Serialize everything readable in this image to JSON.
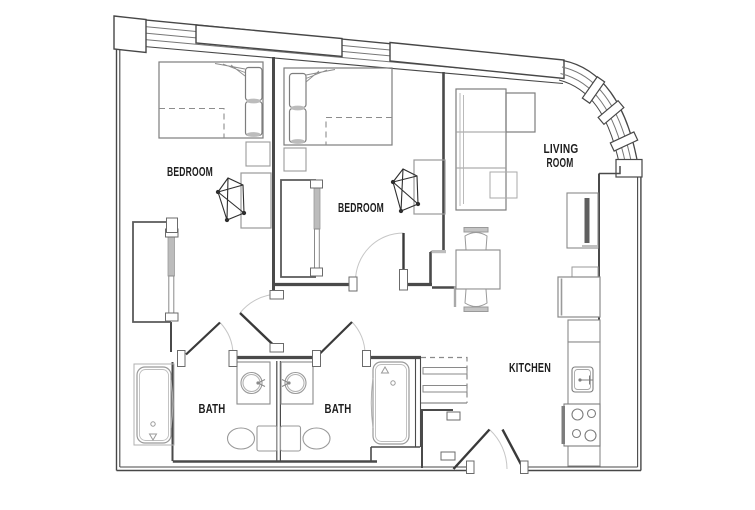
{
  "plan": {
    "type": "apartment-floor-plan",
    "rooms": {
      "bedroom_1": {
        "label": "BEDROOM"
      },
      "bedroom_2": {
        "label": "BEDROOM"
      },
      "living_room": {
        "label_line_1": "LIVING",
        "label_line_2": "ROOM"
      },
      "kitchen": {
        "label": "KITCHEN"
      },
      "bath_1": {
        "label": "BATH"
      },
      "bath_2": {
        "label": "BATH"
      }
    },
    "colors": {
      "background": "#ffffff",
      "wall": "#474747",
      "wall_medium": "#6b6b6b",
      "fixture": "#9a9a9a",
      "fixture_dark": "#7d7d7d",
      "swing_arc": "#c6c6c6",
      "panel_gray": "#bcbcbc",
      "tv_fill": "#5f5f5f",
      "label_text": "#1d1d1d"
    }
  }
}
